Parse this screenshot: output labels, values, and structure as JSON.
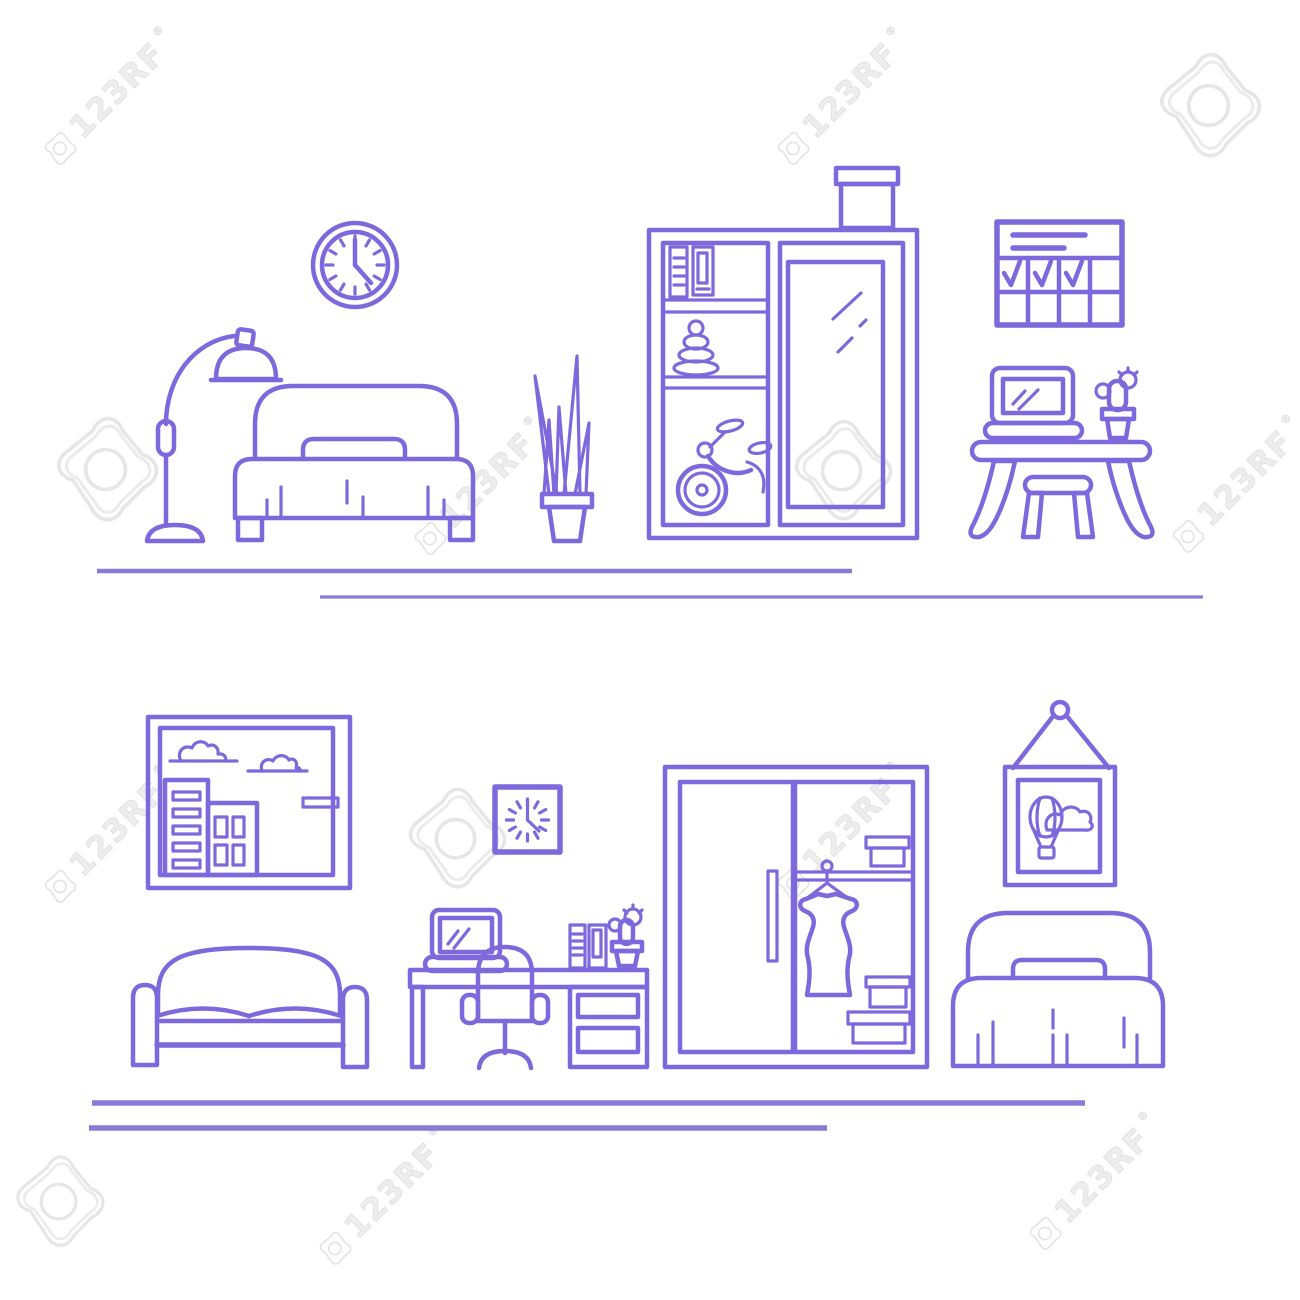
{
  "watermark": {
    "text": "123RF",
    "registered": "®"
  },
  "colors": {
    "background": "#ffffff",
    "line": "#7d68dc",
    "floor_line": "#8a79d6",
    "watermark": "#e2e2e2"
  },
  "icons": {
    "watermark_icon": "watermark-camera-icon",
    "scene_top_items": [
      "floor-lamp",
      "round-wall-clock",
      "single-bed",
      "potted-plant",
      "storage-box",
      "wardrobe-with-shelves-folders-pyramid-tricycle-mirror",
      "wall-calendar-with-checkmarks",
      "laptop",
      "cactus",
      "desk",
      "stool"
    ],
    "scene_bottom_items": [
      "city-picture-frame",
      "sofa",
      "square-wall-clock",
      "laptop",
      "office-chair",
      "desk-with-drawers",
      "binders",
      "cactus",
      "open-wardrobe-with-dress-and-boxes",
      "hanging-balloon-picture",
      "bed"
    ]
  }
}
